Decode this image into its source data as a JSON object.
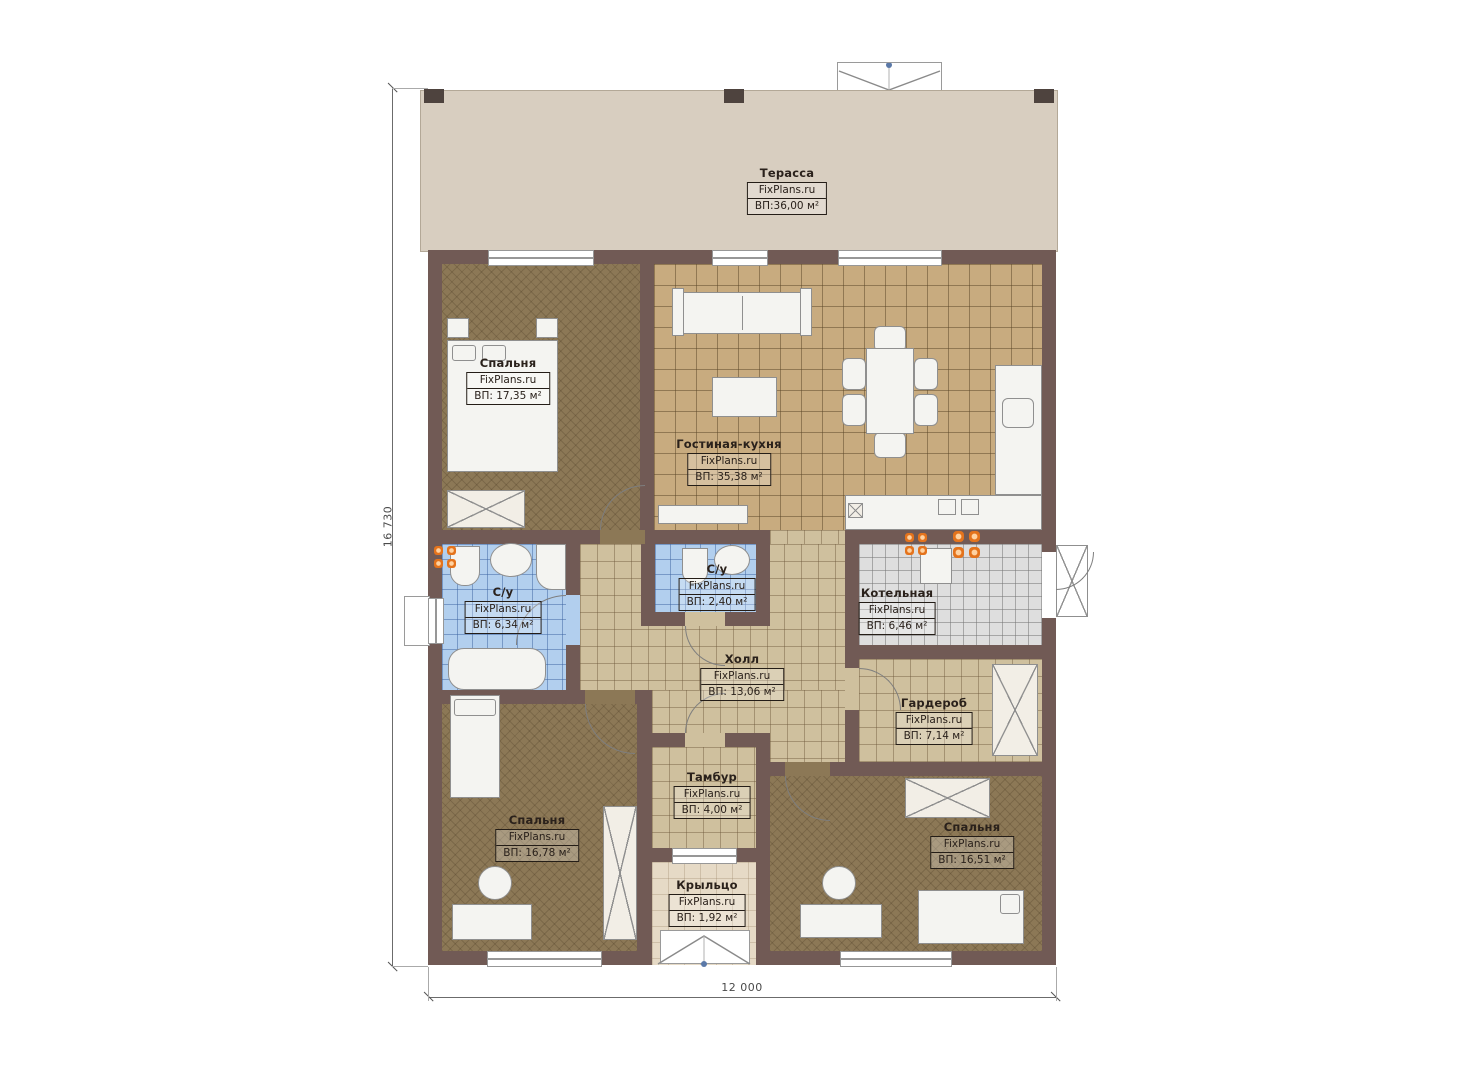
{
  "plan": {
    "watermark": "FixPlans.ru",
    "dimensions": {
      "height_label": "16 730",
      "width_label": "12 000"
    },
    "rooms": [
      {
        "name": "Терасса",
        "source": "FixPlans.ru",
        "area": "ВП:36,00 м²"
      },
      {
        "name": "Спальня",
        "source": "FixPlans.ru",
        "area": "ВП: 17,35 м²"
      },
      {
        "name": "Гостиная-кухня",
        "source": "FixPlans.ru",
        "area": "ВП: 35,38 м²"
      },
      {
        "name": "С/у",
        "source": "FixPlans.ru",
        "area": "ВП: 6,34 м²"
      },
      {
        "name": "С/у",
        "source": "FixPlans.ru",
        "area": "ВП: 2,40 м²"
      },
      {
        "name": "Котельная",
        "source": "FixPlans.ru",
        "area": "ВП: 6,46 м²"
      },
      {
        "name": "Холл",
        "source": "FixPlans.ru",
        "area": "ВП: 13,06 м²"
      },
      {
        "name": "Гардероб",
        "source": "FixPlans.ru",
        "area": "ВП: 7,14 м²"
      },
      {
        "name": "Тамбур",
        "source": "FixPlans.ru",
        "area": "ВП: 4,00 м²"
      },
      {
        "name": "Спальня",
        "source": "FixPlans.ru",
        "area": "ВП: 16,78 м²"
      },
      {
        "name": "Спальня",
        "source": "FixPlans.ru",
        "area": "ВП: 16,51 м²"
      },
      {
        "name": "Крыльцо",
        "source": "FixPlans.ru",
        "area": "ВП: 1,92 м²"
      }
    ],
    "colors": {
      "wall": "#715a55",
      "terrace": "#d8cec0",
      "bedroom_floor": "#8c7856",
      "living_tile": "#c8ab7f",
      "hall_tile": "#cfc09e",
      "bathroom_tile": "#b2cfee",
      "boiler_tile": "#dedede",
      "porch": "#e6dac6",
      "burner_orange": "#e4731c"
    }
  }
}
